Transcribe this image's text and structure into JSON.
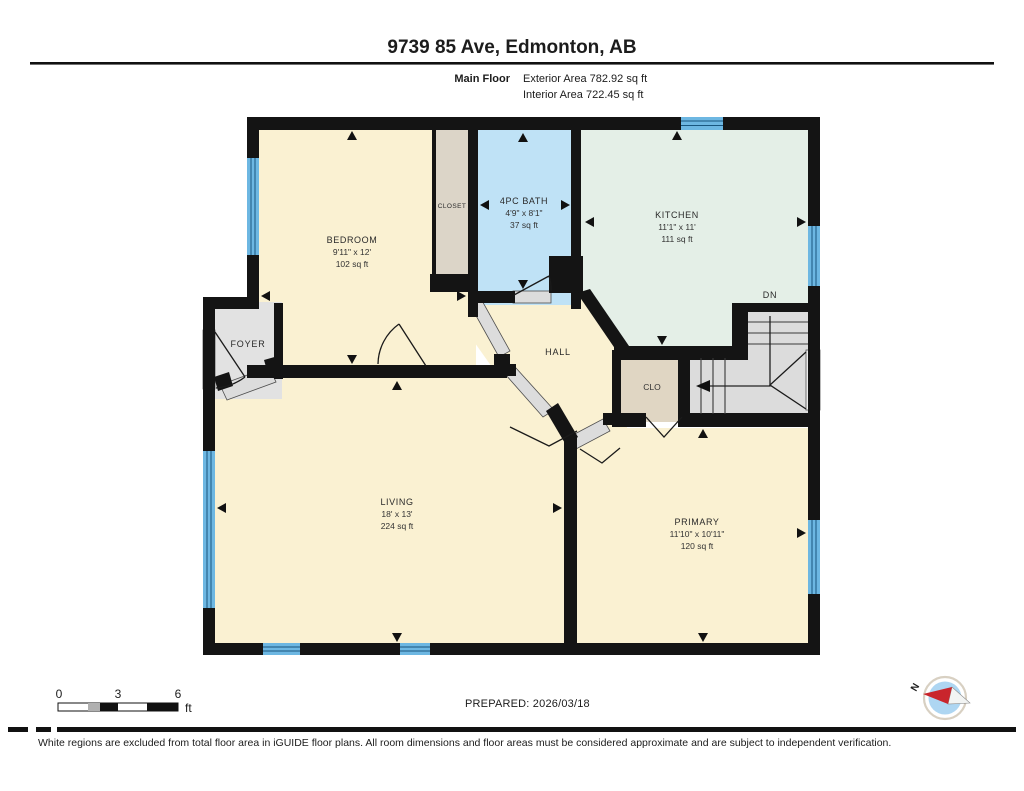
{
  "header": {
    "title": "9739 85 Ave, Edmonton, AB",
    "floor_label": "Main Floor",
    "exterior_area": "Exterior Area 782.92 sq ft",
    "interior_area": "Interior Area 722.45 sq ft"
  },
  "rooms": [
    {
      "name": "BEDROOM",
      "dims": "9'11\" x 12'",
      "area": "102 sq ft"
    },
    {
      "name": "CLOSET"
    },
    {
      "name": "4PC BATH",
      "dims": "4'9\" x 8'1\"",
      "area": "37 sq ft"
    },
    {
      "name": "KITCHEN",
      "dims": "11'1\" x 11'",
      "area": "111 sq ft"
    },
    {
      "name": "FOYER"
    },
    {
      "name": "HALL"
    },
    {
      "name": "CLO"
    },
    {
      "name": "LIVING",
      "dims": "18' x 13'",
      "area": "224 sq ft"
    },
    {
      "name": "PRIMARY",
      "dims": "11'10\" x 10'11\"",
      "area": "120 sq ft"
    }
  ],
  "stairs_label": "DN",
  "compass_label": "N",
  "scale_bar": {
    "tick_0": "0",
    "tick_3": "3",
    "tick_6": "6",
    "unit": "ft"
  },
  "footer": {
    "prepared": "PREPARED: 2026/03/18",
    "disclaimer": "White regions are excluded from total floor area in iGUIDE floor plans. All room dimensions and floor areas must be considered approximate and are subject to independent verification."
  },
  "colors": {
    "room_cream": "#FAF1D2",
    "room_mint": "#E4EFE7",
    "room_blue": "#BFE2F6",
    "room_gray": "#E2E2E2",
    "room_tan": "#E0D6C3",
    "stair_gray": "#DCDCDC",
    "wall": "#141414",
    "window_blue": "#6DB7E2",
    "compass_red": "#C9252C"
  }
}
